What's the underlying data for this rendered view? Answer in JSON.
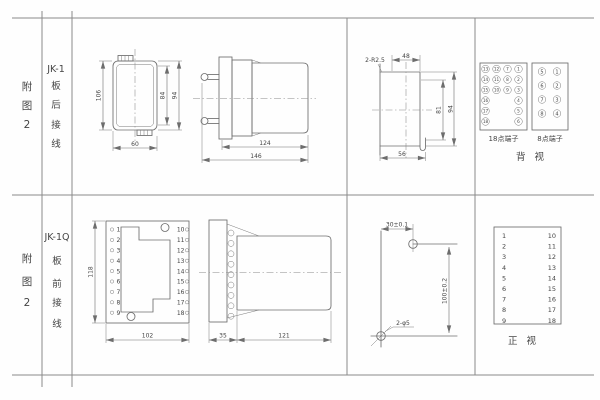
{
  "page": {
    "bg": "#fefefe",
    "line_color": "#6d6d6d",
    "text_color": "#444444"
  },
  "rows": [
    {
      "fig": [
        "附",
        "图",
        "2"
      ],
      "model": "JK-1",
      "wiring": [
        "板",
        "后",
        "接",
        "线"
      ]
    },
    {
      "fig": [
        "附",
        "图",
        "2"
      ],
      "model": "JK-1Q",
      "wiring": [
        "板",
        "前",
        "接",
        "线"
      ]
    }
  ],
  "jk1": {
    "front": {
      "h106": "106",
      "h84": "84",
      "h94": "94",
      "w60": "60"
    },
    "side": {
      "d124": "124",
      "d146": "146"
    },
    "cutout": {
      "note": "2-R2.5",
      "w48": "48",
      "h81": "81",
      "h94": "94",
      "w56": "56"
    },
    "rear": {
      "block18_label": "18点端子",
      "block8_label": "8点端子",
      "view_label": "背视",
      "t18": [
        "13",
        "12",
        "7",
        "1",
        "14",
        "11",
        "8",
        "2",
        "15",
        "10",
        "9",
        "3",
        "16",
        "4",
        "17",
        "5",
        "18",
        "6"
      ],
      "t8": [
        "5",
        "1",
        "6",
        "2",
        "7",
        "3",
        "8",
        "4"
      ]
    }
  },
  "jk1q": {
    "front": {
      "h118": "118",
      "w102": "102",
      "left": [
        "1",
        "2",
        "3",
        "4",
        "5",
        "6",
        "7",
        "8",
        "9"
      ],
      "right": [
        "10",
        "11",
        "12",
        "13",
        "14",
        "15",
        "16",
        "17",
        "18"
      ]
    },
    "side": {
      "p35": "35",
      "b121": "121"
    },
    "drill": {
      "h30": "30±0.1",
      "v100": "100±0.2",
      "note": "2-φ5"
    },
    "table": {
      "left": [
        "1",
        "2",
        "3",
        "4",
        "5",
        "6",
        "7",
        "8",
        "9"
      ],
      "right": [
        "10",
        "11",
        "12",
        "13",
        "14",
        "15",
        "16",
        "17",
        "18"
      ],
      "view_label": "正视"
    }
  }
}
